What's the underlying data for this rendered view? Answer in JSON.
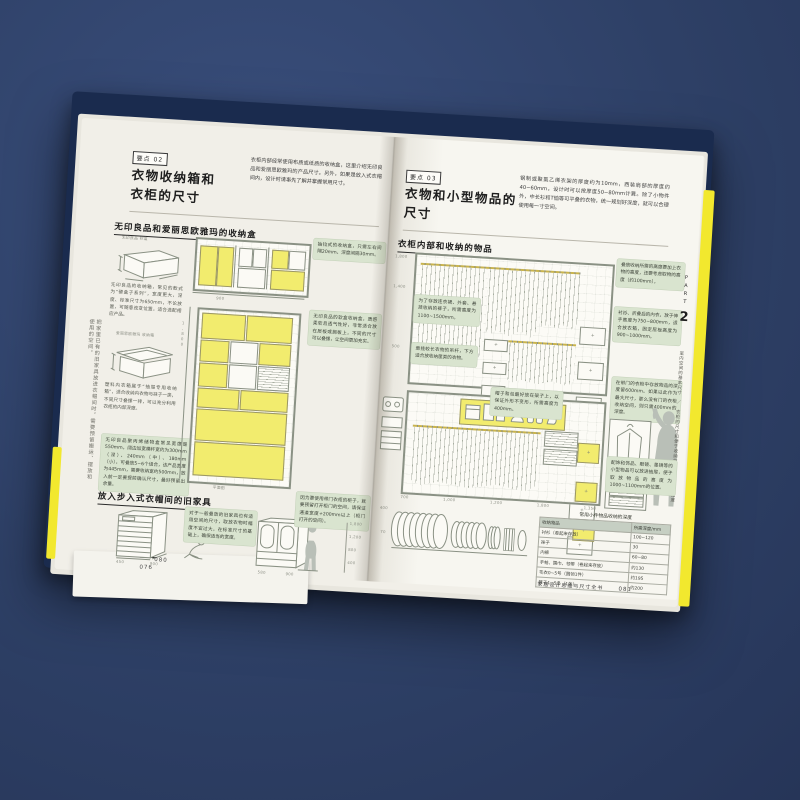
{
  "scene": {
    "background_color": "#2e4066",
    "cover_color": "#1a2b4e",
    "edge_highlight_color": "#f2e82e",
    "note_color": "#d9e4cf",
    "highlight_color": "#f2ec6e"
  },
  "left_page": {
    "margin_note": "把家里已有的旧家具放进衣帽间时，需要预留搬运、摆放和使用的空间。",
    "prev_page_number": "076",
    "page_number": "080",
    "badge": "要点 02",
    "title1": "衣物收纳箱和",
    "title2": "衣柜的尺寸",
    "intro": "衣柜内部经常使用布质或纸质的收纳盒，这里介绍无印良品和爱丽思欧雅玛的产品尺寸。另外，如果是放入式衣帽间内，设计时请事先了解并掌握常用尺寸。",
    "sec1_heading": "无印良品和爱丽思欧雅玛的收纳盒",
    "box1_label": "无印良品 软盒",
    "box2_label": "爱丽思欧雅玛 收纳箱",
    "cap1": "无印良品的收纳箱，常见的款式为“硬盒子系列”，宽度更大，深度、标准尺寸为650mm，不论放置，可随意改变位置，适合选配相应产品。",
    "cap2": "塑料内衣箱属于“抽屉专用收纳箱”，适合收纳内衣物与袜子一类，不同尺寸叠摞一排，可以充分利用衣柜的内部深度。",
    "cap3": "无印良品聚丙烯储物盒常见宽度是550mm，阔边加宽横杆宽约为300mm（深）、240mm（中）、180mm（小），可叠放5~6个组合，该产品宽度为445mm，需要收纳宽约500mm，放入前一定要提前确认尺寸，最好预留出余量。",
    "note1": "抽拉式的收纳盒，只需左右间隔20mm、深度间隔30mm。",
    "note2": "无印良品的软盒收纳盒，质感柔软且透气性好，非常适合放在层板或搁板上，不同的尺寸可以叠摞，让空间更加充实。",
    "plan_label": "平面图",
    "sec2_heading": "放入步入式衣帽间的旧家具",
    "sec2_note1": "对于一般叠放的旧家具也有适用空间的尺寸，取放衣物时幅度不宜过大，在标准尺寸的基础上，确保适当的宽度。",
    "sec2_note2": "因为要使用带门衣柜的柜子，就要预留打开柜门的空间，请保证通道宽度+200mm以上（柜门打开的空间）。",
    "sec2_scale": [
      "1,800",
      "1,200",
      "800",
      "400"
    ],
    "chest_dims": [
      "450",
      "900"
    ],
    "wardrobe_dims": [
      "580",
      "900"
    ]
  },
  "right_page": {
    "badge": "要点 03",
    "title1": "衣物和小型物品的",
    "title2": "尺寸",
    "intro": "钢制或聚氯乙烯衣架的厚度约为10mm，西装肩部的厚度约40~60mm，设计时可以按厚度50~80mm计算。除了小物件外，中长衫和T恤等可平叠的衣物，统一规划好深度，就可以合理使用每一寸空间。",
    "sec_heading": "衣柜内部和收纳的物品",
    "d1_note_l1": "为了存放连衣裙、外套、悬挂收纳的裤子，所需高度为1100~1500mm。",
    "d1_note_l2": "悬挂较长衣物的吊杆，下方适合放收纳筐类的衣物。",
    "d1_note_r1": "叠放收纳所需的高度要加上衣物的高度，还要考虑取物的高度（约100mm）。",
    "d1_note_r2": "衬衫、折叠后的内衣，放于伸手高度为750~800mm，适合放衣箱，固定层板高度为900~1000mm。",
    "d1_scale": [
      "1,800",
      "1,400",
      "500"
    ],
    "d2_note_m": "帽子和包最好放在架子上，以保证外形不变形，所需高度为400mm。",
    "d2_note_r1": "在带门的衣柜中存放物品的深度留600mm。如果以此作为最大尺寸，那么没有门的衣柜收纳空间，则只需400mm的深度。",
    "d2_note_r2": "配饰和饰品、眼镜、墨镜等的小型物品可以放进抽屉，便于取放物品的高度为1000~1100mm的位置。",
    "bottom_dims": [
      "700",
      "1,000",
      "1,200",
      "1,800",
      "1,350"
    ],
    "roll_dims": [
      "400",
      "70"
    ],
    "table": {
      "title": "常用小件物品收纳的深度",
      "headers": [
        "收纳物品",
        "所需深度/mm"
      ],
      "rows": [
        [
          "衬衫（卷起来存放）",
          "100~120"
        ],
        [
          "袜子",
          "30"
        ],
        [
          "内裤",
          "60~80"
        ],
        [
          "手帕、围巾、领带（卷起来存放）",
          "约130"
        ],
        [
          "毛衣0~5号（圆领1件）",
          "约195"
        ],
        [
          "裤子1~5条（1条）",
          "约200"
        ]
      ]
    },
    "footer_title": "家居设计思维与尺寸全书",
    "page_number": "081",
    "part_label": "PART",
    "part_number": "2",
    "part_caption": "室内空间的基本尺寸　／　衣柜的尺寸和便于收纳的物品和通道的宽度"
  }
}
